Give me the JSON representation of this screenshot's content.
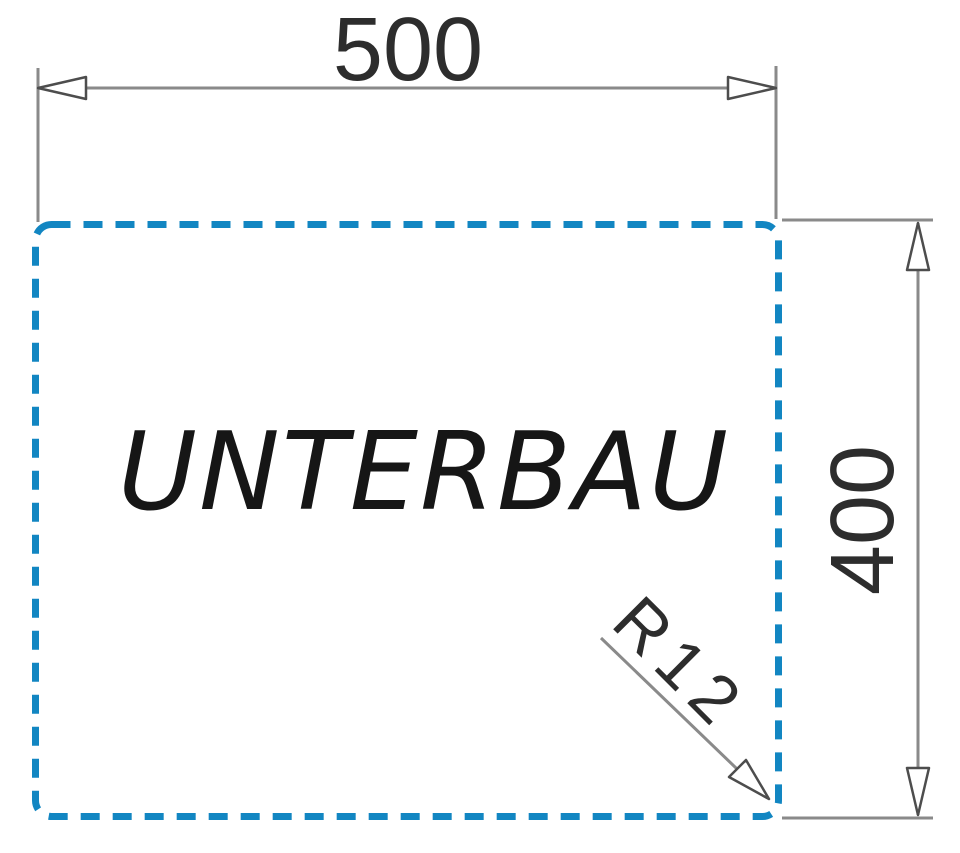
{
  "diagram": {
    "cabinet_label": "UNTERBAU",
    "width_dimension_mm": "500",
    "height_dimension_mm": "400",
    "corner_radius_label": "R12"
  },
  "colors": {
    "outline_blue": "#1286c2",
    "dimension_gray": "#8a8a8a",
    "arrow_outline_gray": "#4d4d4d",
    "arrow_fill": "#ffffff",
    "label_text": "#161616",
    "dimension_text": "#2d2d2d"
  }
}
